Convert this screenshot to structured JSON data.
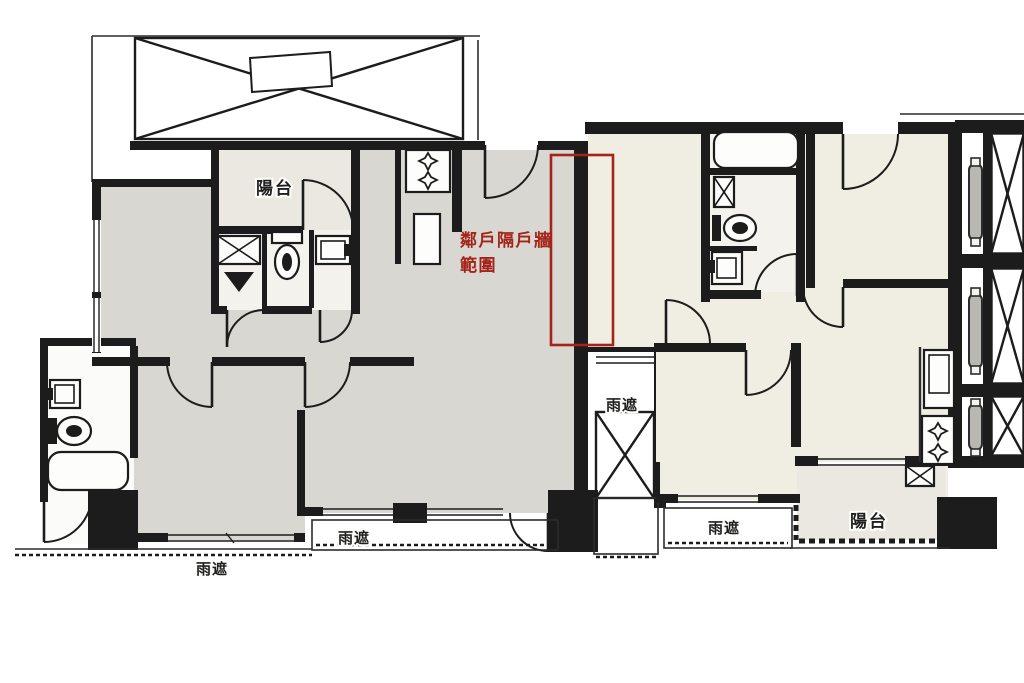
{
  "figure": {
    "kind": "apartment-floor-plan"
  },
  "labels": {
    "balcony_left": "陽台",
    "balcony_right": "陽台",
    "rain_shelter_sw": "雨遮",
    "rain_shelter_s": "雨遮",
    "rain_shelter_mid": "雨遮",
    "rain_shelter_se": "雨遮"
  },
  "annotation": {
    "line1": "鄰戶隔戶牆",
    "line2": "範圍"
  },
  "colors": {
    "wall": "#1c1c1c",
    "line": "#2b2b2b",
    "unit_left_fill": "#d8d7d1",
    "unit_right_fill": "#f0eee2",
    "balcony_fill": "#eae8e0",
    "bath_fill": "#f3f2ec",
    "annotation_red": "#a5241a",
    "background": "#ffffff"
  }
}
